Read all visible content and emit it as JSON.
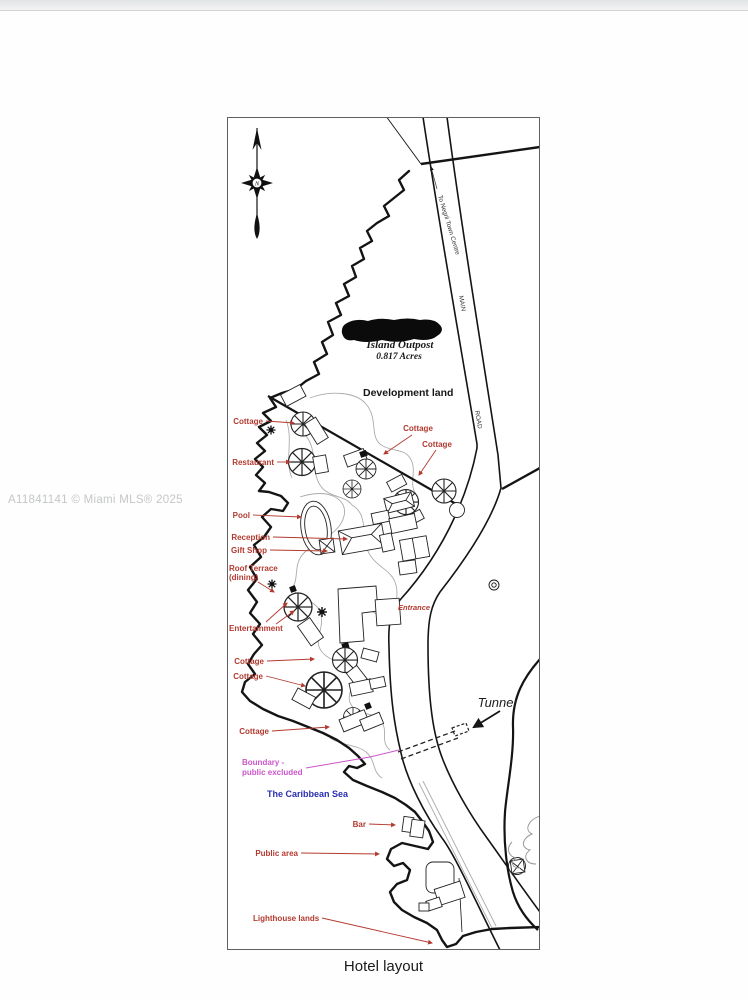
{
  "page": {
    "watermark": "A11841141 © Miami MLS® 2025",
    "caption": "Hotel layout"
  },
  "map": {
    "compass_letter": "N",
    "road_labels": {
      "to_town": "To Negril Town Centre",
      "main": "MAIN",
      "road": "ROAD"
    },
    "parcel": {
      "name": "Island Outpost",
      "area": "0.817  Acres"
    },
    "annotations": {
      "development_land": "Development land",
      "entrance": "Entrance",
      "tunnel": "Tunnel",
      "sea": "The Caribbean Sea",
      "boundary_1": "Boundary -",
      "boundary_2": "public excluded",
      "cottage_nw": "Cottage",
      "cottage_mid": "Cottage",
      "cottage_ne": "Cottage",
      "restaurant": "Restaurant",
      "pool": "Pool",
      "reception": "Reception",
      "gift_shop": "Gift Shop",
      "roof_terrace_1": "Roof Terrace",
      "roof_terrace_2": "(dining)",
      "entertainment": "Entertainment",
      "cottage_w1": "Cottage",
      "cottage_w2": "Cottage",
      "cottage_sw": "Cottage",
      "bar": "Bar",
      "public_area": "Public area",
      "lighthouse_lands": "Lighthouse lands"
    },
    "colors": {
      "label_red": "#b33a2f",
      "boundary_magenta": "#cc55cb",
      "sea_blue": "#2a2fb0",
      "ink": "#141414",
      "path_gray": "#ababab",
      "watermark_gray": "#c4c6c8"
    }
  }
}
